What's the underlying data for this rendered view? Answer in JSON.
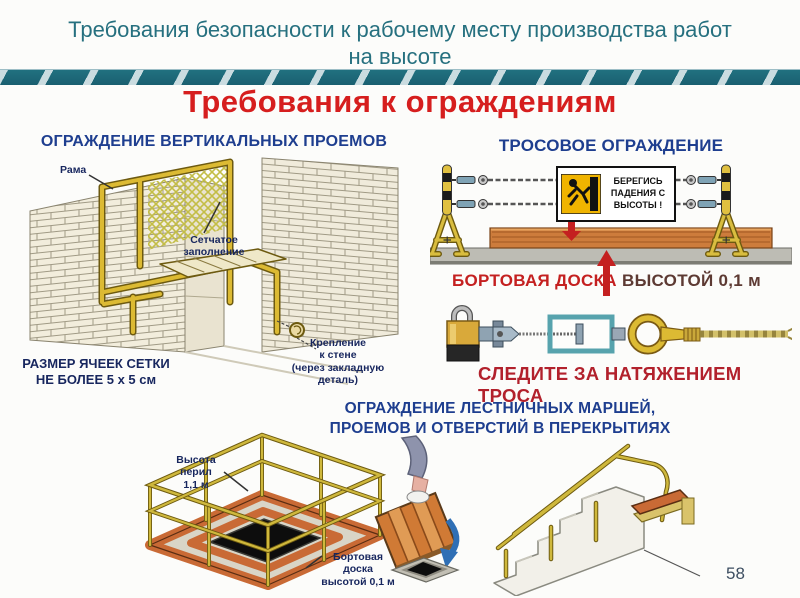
{
  "header": {
    "title_line1": "Требования безопасности к рабочему месту производства работ",
    "title_line2": "на высоте",
    "heading": "Требования к ограждениям",
    "page_number": "58"
  },
  "vertical_openings": {
    "title": "ОГРАЖДЕНИЕ ВЕРТИКАЛЬНЫХ ПРОЕМОВ",
    "frame_label": "Рама",
    "mesh_label": "Сетчатое\nзаполнение",
    "mesh_size_label": "РАЗМЕР ЯЧЕЕК СЕТКИ\nНЕ БОЛЕЕ 5 х 5 см",
    "wall_mount_label": "Крепление\nк стене\n(через закладную\nдеталь)"
  },
  "cable_fence": {
    "title": "ТРОСОВОЕ ОГРАЖДЕНИЕ",
    "warning_sign_text": "БЕРЕГИСЬ\nПАДЕНИЯ С\nВЫСОТЫ !",
    "board_label": "БОРТОВАЯ ДОСКА",
    "board_height_label": "ВЫСОТОЙ 0,1 м",
    "tension_label": "СЛЕДИТЕ ЗА НАТЯЖЕНИЕМ ТРОСА"
  },
  "floor_openings": {
    "title": "ОГРАЖДЕНИЕ ЛЕСТНИЧНЫХ МАРШЕЙ,\nПРОЕМОВ И ОТВЕРСТИЙ В ПЕРЕКРЫТИЯХ",
    "rail_height_label": "Высота\nперил\n1,1 м",
    "toe_board_label": "Бортовая\nдоска\nвысотой 0,1 м"
  },
  "colors": {
    "title_teal": "#26707f",
    "ribbon_teal": "#1e6b7e",
    "heading_red": "#d61e1e",
    "section_blue": "#1e3e8f",
    "label_navy": "#17265e",
    "warning_red": "#c42020",
    "board_caption_maroon": "#5d3a33",
    "tension_crimson": "#b2212c",
    "sign_yellow": "#f0b400",
    "frame_yellow": "#dcba33",
    "board_orange": "#cd7c3c"
  }
}
